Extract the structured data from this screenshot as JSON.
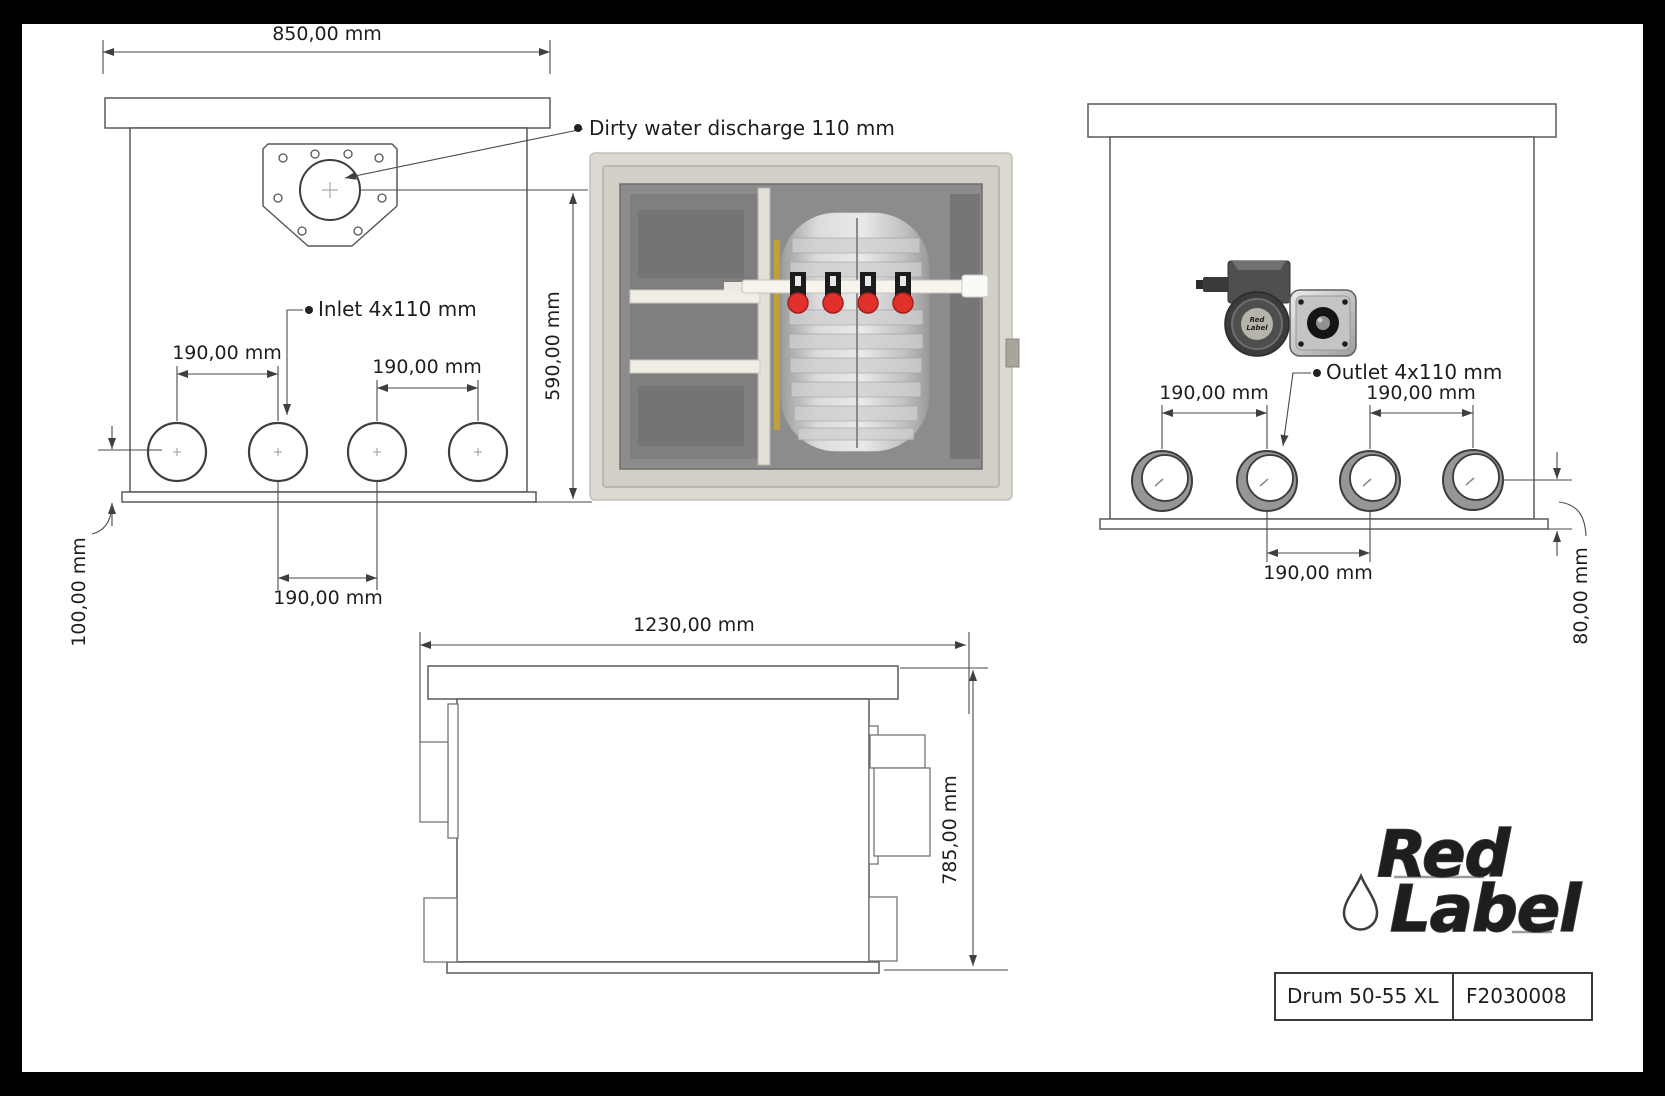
{
  "front_view": {
    "dim_width": "850,00 mm",
    "dim_height": "590,00 mm",
    "label_discharge": "Dirty water discharge 110 mm",
    "label_inlet": "Inlet 4x110 mm",
    "dim_pitch_left": "190,00 mm",
    "dim_pitch_right": "190,00 mm",
    "dim_pitch_bottom": "190,00 mm",
    "dim_base_height": "100,00 mm"
  },
  "back_view": {
    "label_outlet": "Outlet 4x110 mm",
    "dim_pitch_left": "190,00 mm",
    "dim_pitch_right": "190,00 mm",
    "dim_pitch_bottom": "190,00 mm",
    "dim_outlet_height": "80,00 mm"
  },
  "side_view": {
    "dim_length": "1230,00 mm",
    "dim_height": "785,00 mm"
  },
  "logo": {
    "word1": "Red",
    "word2": "Label"
  },
  "title_block": {
    "model": "Drum 50-55 XL",
    "code": "F2030008"
  },
  "colors": {
    "logo_red": "#e8221c",
    "valve_red": "#e2302a",
    "line_gray": "#4a4a4a",
    "photo_body": "#dcd9d1",
    "photo_interior": "#8c8c8c",
    "canvas": "#ffffff",
    "frame": "#000000"
  }
}
